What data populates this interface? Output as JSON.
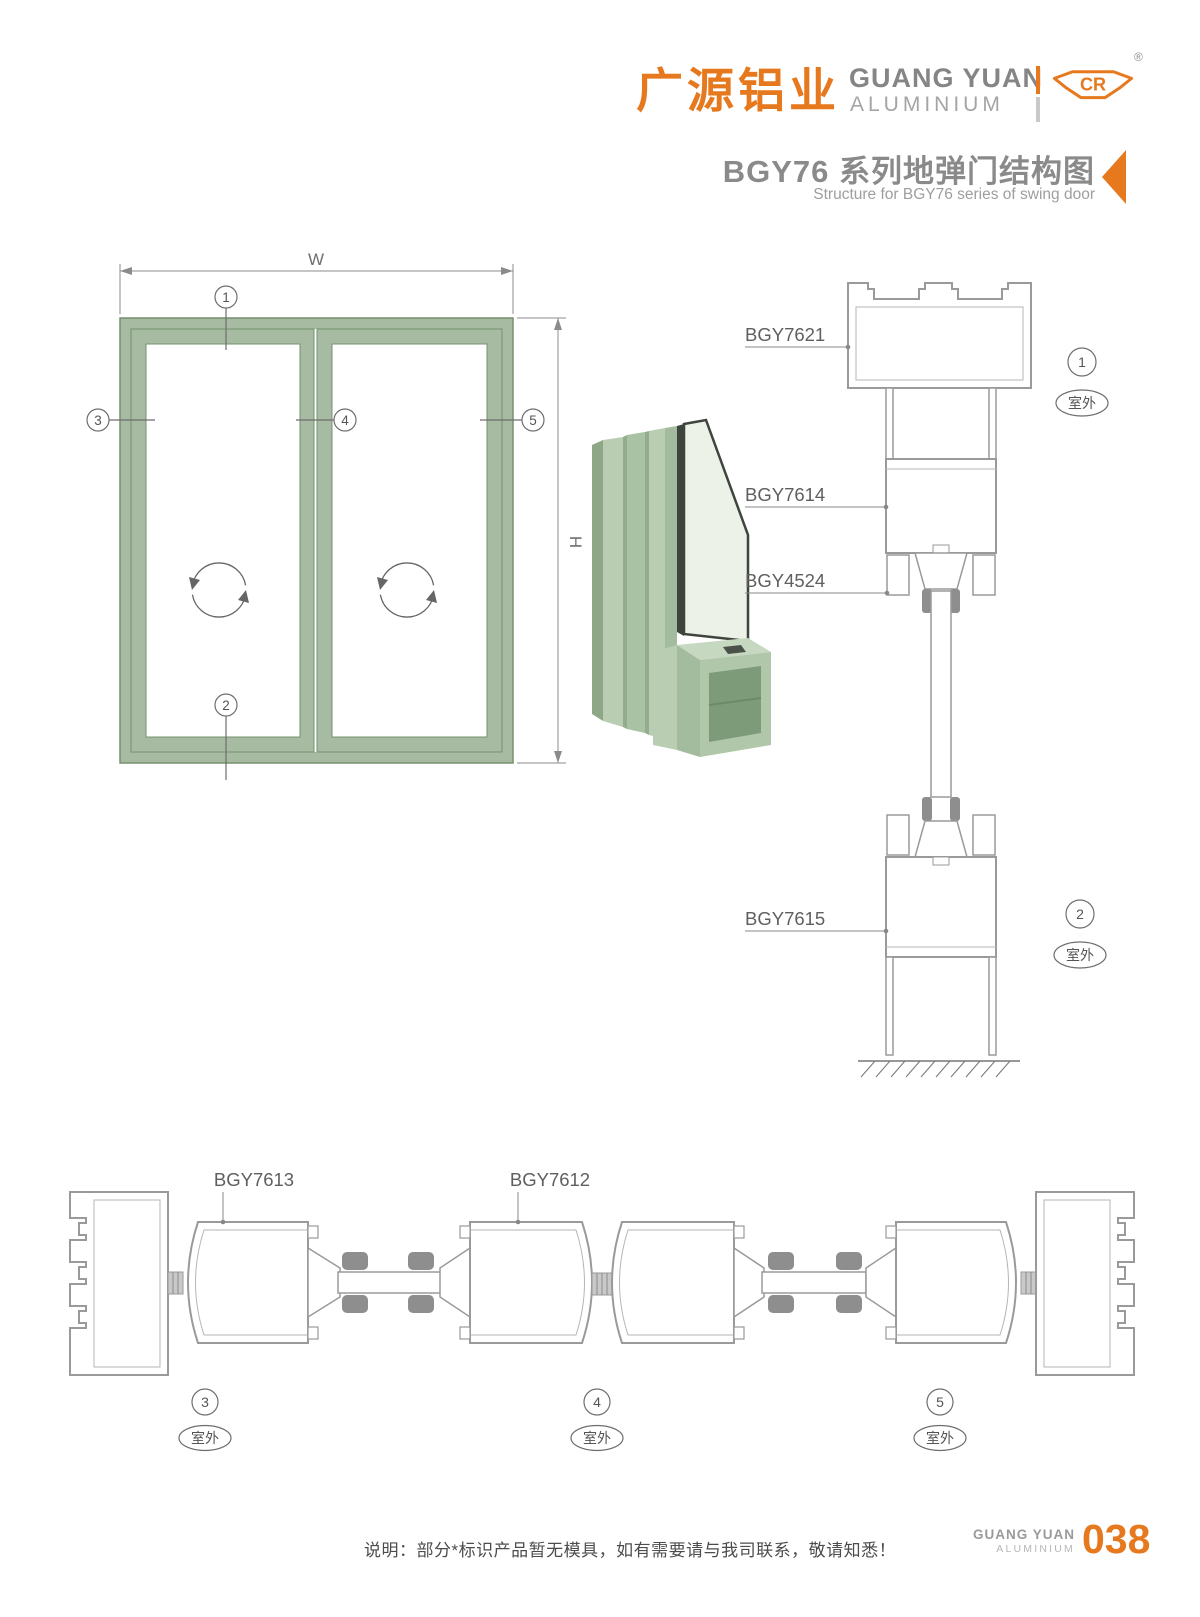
{
  "header": {
    "logo_cn": "广源铝业",
    "logo_en_line1": "GUANG YUAN",
    "logo_en_line2": "ALUMINIUM",
    "logo_mark": "CR",
    "registered_mark": "®",
    "title_cn": "BGY76 系列地弹门结构图",
    "title_en": "Structure for BGY76 series of swing door"
  },
  "elevation": {
    "width_label": "W",
    "height_label": "H",
    "callout_1": "1",
    "callout_2": "2",
    "callout_3": "3",
    "callout_4": "4",
    "callout_5": "5"
  },
  "vertical_section": {
    "label_top_frame": "BGY7621",
    "label_door_top_rail": "BGY7614",
    "label_glazing_bead": "BGY4524",
    "label_bottom_rail": "BGY7615",
    "callout_1": "1",
    "callout_2": "2",
    "outdoor": "室外"
  },
  "horizontal_section": {
    "label_hinge_stile": "BGY7613",
    "label_meeting_stile": "BGY7612",
    "callout_3": "3",
    "callout_4": "4",
    "callout_5": "5",
    "outdoor": "室外"
  },
  "footer": {
    "note": "说明：部分*标识产品暂无模具，如有需要请与我司联系，敬请知悉！",
    "brand_line1": "GUANG YUAN",
    "brand_line2": "ALUMINIUM",
    "page_number": "038"
  },
  "colors": {
    "brand_orange": "#e6791e",
    "title_gray": "#8a8a8a",
    "drawing_line_gray": "#9a9a9a",
    "gasket_gray": "#8e8e8e",
    "frame_green": "#a7bba2",
    "frame_green_line": "#76906f"
  }
}
